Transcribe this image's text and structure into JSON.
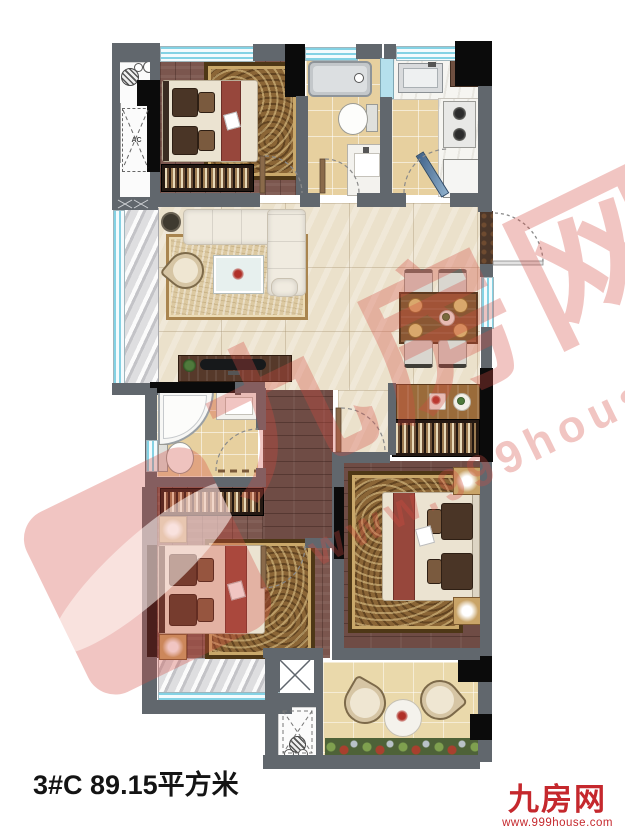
{
  "title_block": {
    "area_label": "3#C 89.15平方米"
  },
  "branding": {
    "site_name": "九房网",
    "site_url": "www.999house.com"
  },
  "watermark": {
    "site_name": "九房网",
    "site_url": "www.999house.com"
  },
  "labels": {
    "ac": "AC"
  },
  "palette": {
    "wall": "#61676d",
    "wall-black": "#0b0b0b",
    "window": "#84d2e4",
    "marble-floor": "#ebe1cb",
    "wood-floor": "#7b564e",
    "tile-floor": "#e7d09f",
    "rug": "#8a6536",
    "brand": "#c5282d",
    "wm": "rgba(213,74,66,0.32)"
  }
}
